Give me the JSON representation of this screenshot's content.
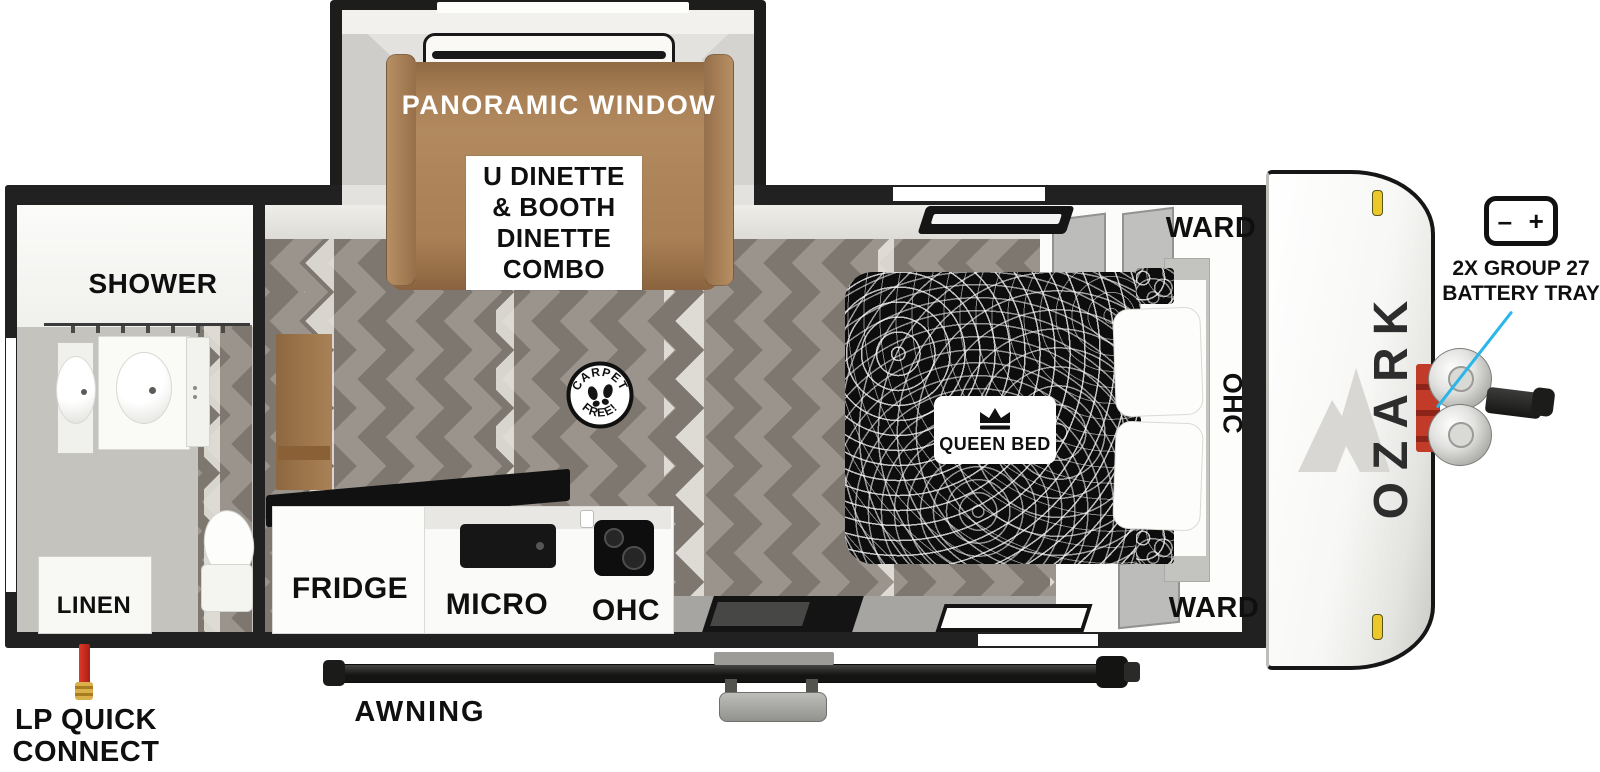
{
  "slideout": {
    "panoramic_window_label": "PANORAMIC WINDOW",
    "dinette_lines": [
      "U DINETTE",
      "& BOOTH",
      "DINETTE",
      "COMBO"
    ]
  },
  "bathroom": {
    "shower_label": "SHOWER",
    "linen_label": "LINEN"
  },
  "kitchen": {
    "fridge_label": "FRIDGE",
    "micro_label": "MICRO",
    "ohc_label": "OHC"
  },
  "bedroom": {
    "queen_bed_label": "QUEEN BED",
    "ward_top_label": "WARD",
    "ohc_label": "OHC",
    "ward_bottom_label": "WARD"
  },
  "badge": {
    "arc_top": "CARPET",
    "arc_bottom": "FREE!"
  },
  "exterior": {
    "brand": "OZARK",
    "awning_label": "AWNING",
    "lp_quick_connect_lines": [
      "LP QUICK",
      "CONNECT"
    ],
    "battery_tray_lines": [
      "2X GROUP 27",
      "BATTERY TRAY"
    ],
    "battery_minus": "–",
    "battery_plus": "+"
  },
  "colors": {
    "accent_cyan": "#29b6e9",
    "dinette_brown": "#a87f55",
    "lp_red": "#c6281e",
    "brass": "#c79b2f",
    "clearance_yellow": "#ecc829",
    "floor_base": "#9b948c",
    "floor_dark": "#7e7770",
    "floor_streak": "#efece6"
  }
}
